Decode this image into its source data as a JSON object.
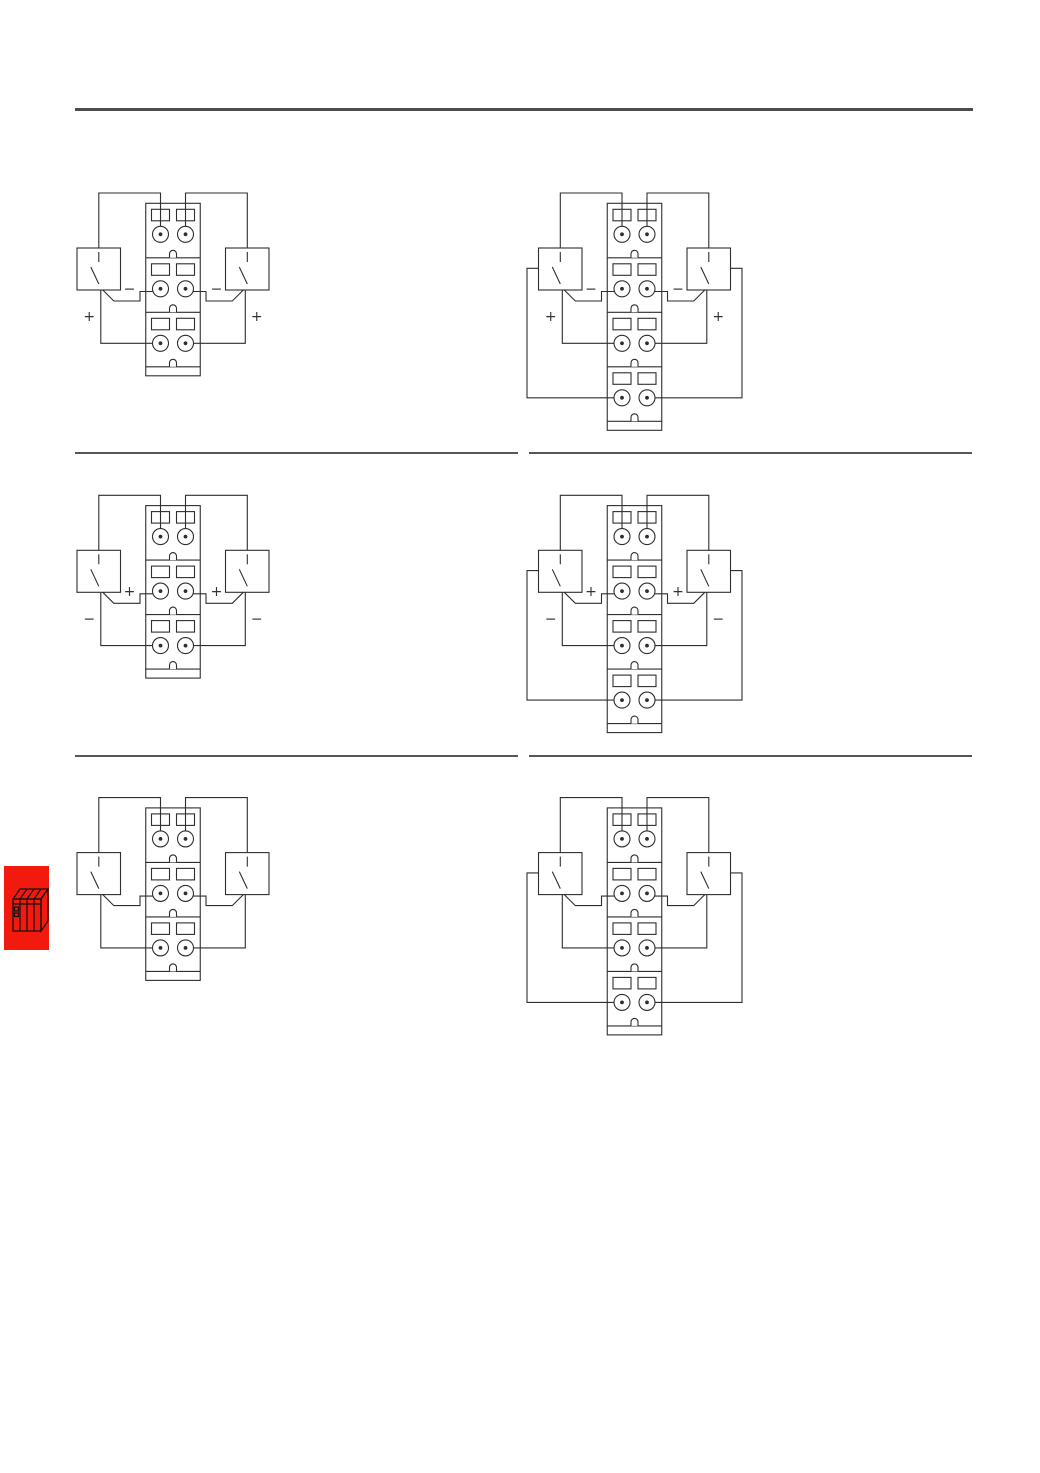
{
  "page": {
    "background": "#ffffff",
    "rule_color": "#4d4d4d",
    "separator_color": "#565656",
    "diagram_line_color": "#2e2e2e",
    "label_color": "#333333"
  },
  "chapter_marker": {
    "icon": "plc-module-icon",
    "background": "#f2190f",
    "icon_line_color": "#111111"
  },
  "diagrams": [
    {
      "id": "top-left",
      "row": 0,
      "col": 0,
      "tiers": 3,
      "inner_label": "−",
      "outer_label": "+"
    },
    {
      "id": "top-right",
      "row": 0,
      "col": 1,
      "tiers": 4,
      "inner_label": "−",
      "outer_label": "+"
    },
    {
      "id": "middle-left",
      "row": 1,
      "col": 0,
      "tiers": 3,
      "inner_label": "+",
      "outer_label": "−"
    },
    {
      "id": "middle-right",
      "row": 1,
      "col": 1,
      "tiers": 4,
      "inner_label": "+",
      "outer_label": "−"
    },
    {
      "id": "bottom-left",
      "row": 2,
      "col": 0,
      "tiers": 3,
      "inner_label": "",
      "outer_label": ""
    },
    {
      "id": "bottom-right",
      "row": 2,
      "col": 1,
      "tiers": 4,
      "inner_label": "",
      "outer_label": ""
    }
  ]
}
